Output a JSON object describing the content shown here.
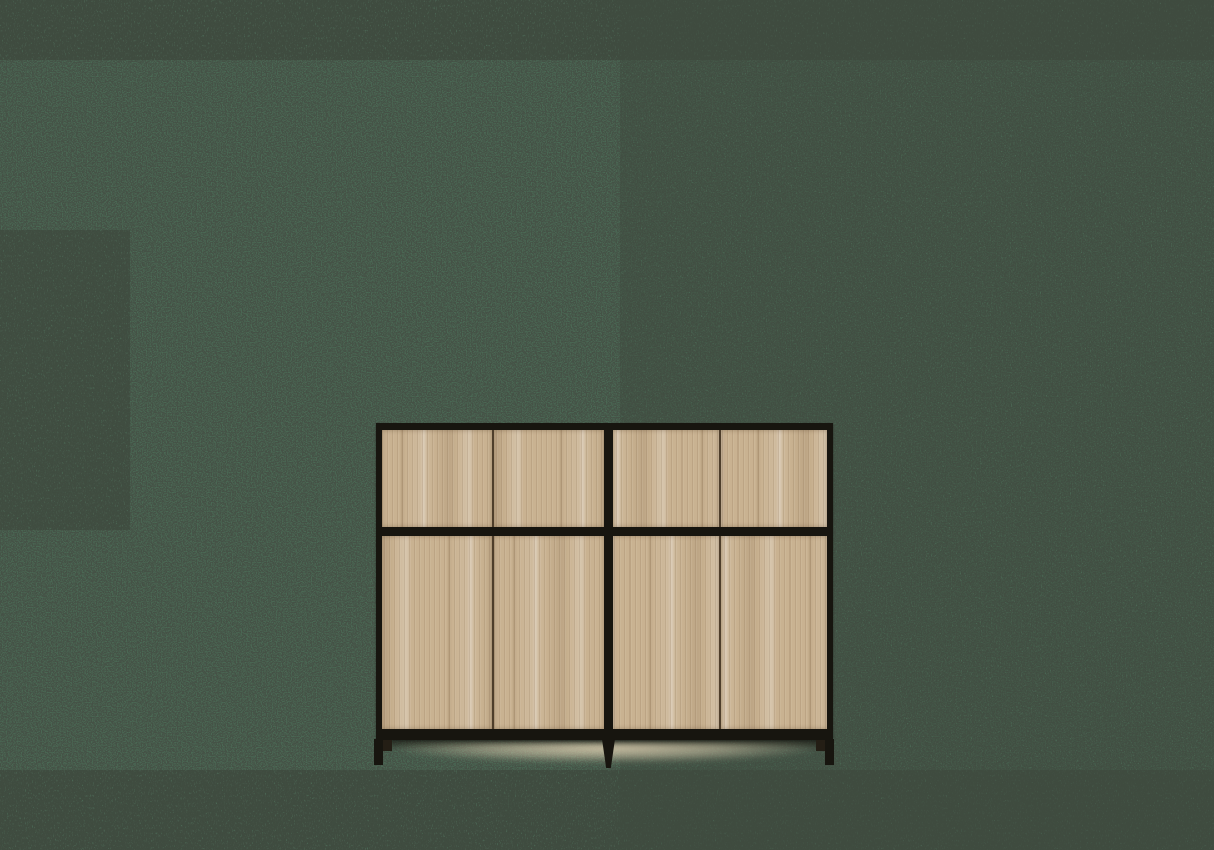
{
  "scene": {
    "type": "product image",
    "object": "two-bay sideboard cabinet",
    "description": "Sideboard with thin black metal frame and legs; each of the two bays has two push-open oak drawer fronts on top and two oak doors below; soft light glow on the floor beneath; plain noisy green backdrop; no visible text."
  },
  "colors": {
    "background": "#4a6854",
    "noise": "#10140f",
    "frame": "#17150f",
    "seam": "#4e3e2b",
    "wood-base": "#c9b291",
    "wood-light": "#e0d1b1",
    "wood-dark": "#a98f6b",
    "foot": "#241e15",
    "floor-glow": "#e2d3b4"
  },
  "furniture": {
    "bays": 2,
    "top_drawers": 4,
    "bottom_doors": 4,
    "legs": 3,
    "handles_visible": false
  }
}
